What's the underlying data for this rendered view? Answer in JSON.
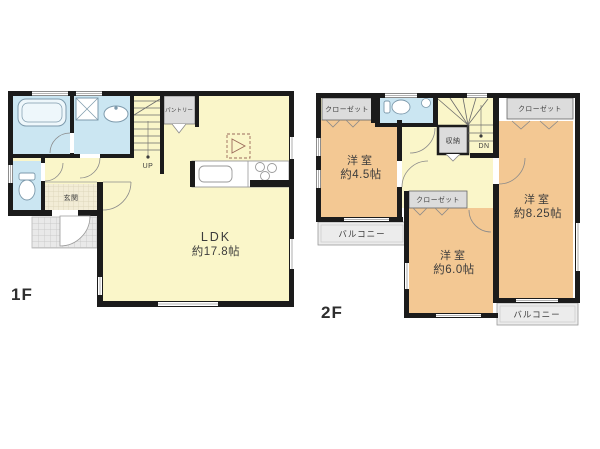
{
  "floor1": {
    "label": "1F",
    "ldk": {
      "name": "LDK",
      "size": "約17.8帖"
    },
    "genkan": {
      "name": "玄関"
    },
    "pantry": {
      "name": "パントリー"
    },
    "stairs": {
      "direction": "UP"
    }
  },
  "floor2": {
    "label": "2F",
    "room_45": {
      "name": "洋室",
      "size": "約4.5帖"
    },
    "room_825": {
      "name": "洋室",
      "size": "約8.25帖"
    },
    "room_60": {
      "name": "洋室",
      "size": "約6.0帖"
    },
    "closet_top_left": {
      "name": "クローゼット"
    },
    "closet_top_right": {
      "name": "クローゼット"
    },
    "closet_middle": {
      "name": "クローゼット"
    },
    "storage": {
      "name": "収納"
    },
    "balcony_left": {
      "name": "バルコニー"
    },
    "balcony_bottom": {
      "name": "バルコニー"
    },
    "stairs": {
      "direction": "DN"
    }
  },
  "colors": {
    "wall": "#1b1b1b",
    "room_yellow": "#faf6c9",
    "room_orange": "#f3c893",
    "wet_blue": "#cbe6f2",
    "closet_gray": "#dcdcdc",
    "balcony_gray": "#ececec",
    "genkan_tan": "#f2ecd6",
    "porch_gray": "#e9e9e9",
    "text": "#3c3c3c"
  }
}
